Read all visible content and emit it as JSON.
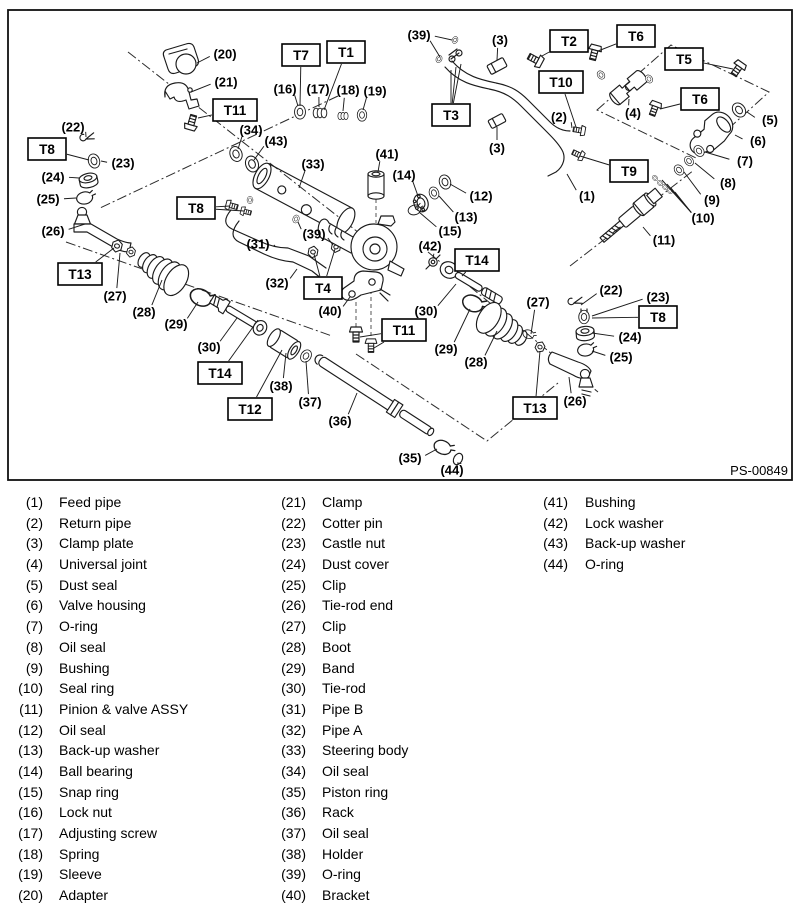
{
  "figure": {
    "code": "PS-00849",
    "part_labels": [
      {
        "t": "(20)",
        "x": 225,
        "y": 54,
        "leads": [
          [
            197,
            63
          ]
        ]
      },
      {
        "t": "(21)",
        "x": 226,
        "y": 82,
        "leads": [
          [
            191,
            92
          ]
        ]
      },
      {
        "t": "(16)",
        "x": 285,
        "y": 89,
        "leads": [
          [
            298,
            106
          ]
        ]
      },
      {
        "t": "(17)",
        "x": 318,
        "y": 89,
        "leads": [
          [
            319,
            107
          ]
        ]
      },
      {
        "t": "(18)",
        "x": 348,
        "y": 90,
        "leads": [
          [
            343,
            111
          ]
        ]
      },
      {
        "t": "(19)",
        "x": 375,
        "y": 91,
        "leads": [
          [
            363,
            110
          ]
        ]
      },
      {
        "t": "(22)",
        "x": 73,
        "y": 127,
        "leads": [
          [
            86,
            137
          ]
        ]
      },
      {
        "t": "(23)",
        "x": 123,
        "y": 163,
        "leads": [
          [
            101,
            161
          ]
        ]
      },
      {
        "t": "(24)",
        "x": 53,
        "y": 177,
        "leads": [
          [
            79,
            178
          ]
        ]
      },
      {
        "t": "(25)",
        "x": 48,
        "y": 199,
        "leads": [
          [
            76,
            198
          ]
        ]
      },
      {
        "t": "(26)",
        "x": 53,
        "y": 231,
        "leads": [
          [
            85,
            224
          ]
        ]
      },
      {
        "t": "(34)",
        "x": 251,
        "y": 130,
        "leads": [
          [
            238,
            149
          ]
        ]
      },
      {
        "t": "(43)",
        "x": 276,
        "y": 141,
        "leads": [
          [
            254,
            160
          ]
        ]
      },
      {
        "t": "(33)",
        "x": 313,
        "y": 164,
        "leads": [
          [
            299,
            188
          ]
        ]
      },
      {
        "t": "(41)",
        "x": 387,
        "y": 154,
        "leads": [
          [
            378,
            172
          ]
        ]
      },
      {
        "t": "(39)",
        "x": 314,
        "y": 234,
        "leads": [
          [
            298,
            222
          ],
          [
            333,
            245
          ]
        ]
      },
      {
        "t": "(39)",
        "x": 419,
        "y": 35,
        "leads": [
          [
            452,
            40
          ],
          [
            440,
            57
          ]
        ]
      },
      {
        "t": "(3)",
        "x": 500,
        "y": 40,
        "leads": [
          [
            497,
            60
          ]
        ]
      },
      {
        "t": "(3)",
        "x": 497,
        "y": 148,
        "leads": [
          [
            497,
            127
          ]
        ]
      },
      {
        "t": "(2)",
        "x": 559,
        "y": 117,
        "leads": [
          [
            572,
            128
          ]
        ]
      },
      {
        "t": "(1)",
        "x": 587,
        "y": 196,
        "leads": [
          [
            567,
            174
          ]
        ]
      },
      {
        "t": "(4)",
        "x": 633,
        "y": 113,
        "leads": [
          [
            629,
            99
          ]
        ]
      },
      {
        "t": "(5)",
        "x": 770,
        "y": 120,
        "leads": [
          [
            747,
            112
          ]
        ]
      },
      {
        "t": "(6)",
        "x": 758,
        "y": 141,
        "leads": [
          [
            735,
            135
          ]
        ]
      },
      {
        "t": "(7)",
        "x": 745,
        "y": 161,
        "leads": [
          [
            705,
            152
          ]
        ]
      },
      {
        "t": "(8)",
        "x": 728,
        "y": 183,
        "leads": [
          [
            695,
            163
          ]
        ]
      },
      {
        "t": "(9)",
        "x": 712,
        "y": 200,
        "leads": [
          [
            684,
            172
          ]
        ]
      },
      {
        "t": "(10)",
        "x": 703,
        "y": 218,
        "leads": [
          [
            667,
            184
          ],
          [
            671,
            188
          ],
          [
            675,
            192
          ],
          [
            662,
            180
          ]
        ]
      },
      {
        "t": "(11)",
        "x": 664,
        "y": 240,
        "leads": [
          [
            643,
            227
          ]
        ]
      },
      {
        "t": "(12)",
        "x": 481,
        "y": 196,
        "leads": [
          [
            450,
            184
          ]
        ]
      },
      {
        "t": "(13)",
        "x": 466,
        "y": 217,
        "leads": [
          [
            439,
            196
          ]
        ]
      },
      {
        "t": "(14)",
        "x": 404,
        "y": 175,
        "leads": [
          [
            418,
            196
          ]
        ]
      },
      {
        "t": "(15)",
        "x": 450,
        "y": 231,
        "leads": [
          [
            419,
            212
          ]
        ]
      },
      {
        "t": "(42)",
        "x": 430,
        "y": 246,
        "leads": [
          [
            433,
            258
          ]
        ]
      },
      {
        "t": "(30)",
        "x": 426,
        "y": 311,
        "leads": [
          [
            456,
            284
          ]
        ]
      },
      {
        "t": "(29)",
        "x": 446,
        "y": 349,
        "leads": [
          [
            470,
            309
          ]
        ]
      },
      {
        "t": "(28)",
        "x": 476,
        "y": 362,
        "leads": [
          [
            497,
            331
          ]
        ]
      },
      {
        "t": "(27)",
        "x": 538,
        "y": 302,
        "leads": [
          [
            531,
            334
          ]
        ]
      },
      {
        "t": "(22)",
        "x": 611,
        "y": 290,
        "leads": [
          [
            581,
            305
          ]
        ]
      },
      {
        "t": "(23)",
        "x": 658,
        "y": 297,
        "leads": [
          [
            592,
            316
          ]
        ]
      },
      {
        "t": "(24)",
        "x": 630,
        "y": 337,
        "leads": [
          [
            592,
            333
          ]
        ]
      },
      {
        "t": "(25)",
        "x": 621,
        "y": 357,
        "leads": [
          [
            592,
            351
          ]
        ]
      },
      {
        "t": "(26)",
        "x": 575,
        "y": 401,
        "leads": [
          [
            569,
            377
          ]
        ]
      },
      {
        "t": "(27)",
        "x": 115,
        "y": 296,
        "leads": [
          [
            120,
            253
          ]
        ]
      },
      {
        "t": "(28)",
        "x": 144,
        "y": 312,
        "leads": [
          [
            162,
            280
          ]
        ]
      },
      {
        "t": "(29)",
        "x": 176,
        "y": 324,
        "leads": [
          [
            198,
            302
          ]
        ]
      },
      {
        "t": "(30)",
        "x": 209,
        "y": 347,
        "leads": [
          [
            237,
            318
          ]
        ]
      },
      {
        "t": "(31)",
        "x": 258,
        "y": 244,
        "leads": [
          [
            275,
            246
          ]
        ]
      },
      {
        "t": "(32)",
        "x": 277,
        "y": 283,
        "leads": [
          [
            297,
            269
          ]
        ]
      },
      {
        "t": "(40)",
        "x": 330,
        "y": 311,
        "leads": [
          [
            350,
            297
          ]
        ]
      },
      {
        "t": "(38)",
        "x": 281,
        "y": 386,
        "leads": [
          [
            286,
            353
          ]
        ]
      },
      {
        "t": "(37)",
        "x": 310,
        "y": 402,
        "leads": [
          [
            306,
            361
          ]
        ]
      },
      {
        "t": "(36)",
        "x": 340,
        "y": 421,
        "leads": [
          [
            357,
            393
          ]
        ]
      },
      {
        "t": "(35)",
        "x": 410,
        "y": 458,
        "leads": [
          [
            437,
            449
          ]
        ]
      },
      {
        "t": "(44)",
        "x": 452,
        "y": 470,
        "leads": [
          [
            457,
            463
          ]
        ]
      }
    ],
    "torque_labels": [
      {
        "t": "T7",
        "x": 301,
        "y": 55,
        "leads": [
          [
            300,
            106
          ]
        ]
      },
      {
        "t": "T1",
        "x": 346,
        "y": 52,
        "leads": [
          [
            324,
            110
          ]
        ]
      },
      {
        "t": "T11",
        "x": 235,
        "y": 110,
        "leads": [
          [
            198,
            118
          ]
        ]
      },
      {
        "t": "T8",
        "x": 47,
        "y": 149,
        "leads": [
          [
            89,
            160
          ]
        ]
      },
      {
        "t": "T8",
        "x": 196,
        "y": 208,
        "leads": [
          [
            230,
            206
          ],
          [
            244,
            211
          ]
        ]
      },
      {
        "t": "T13",
        "x": 80,
        "y": 274,
        "leads": [
          [
            114,
            248
          ]
        ]
      },
      {
        "t": "T14",
        "x": 220,
        "y": 373,
        "leads": [
          [
            258,
            320
          ]
        ]
      },
      {
        "t": "T12",
        "x": 250,
        "y": 409,
        "leads": [
          [
            282,
            350
          ]
        ]
      },
      {
        "t": "T2",
        "x": 569,
        "y": 41,
        "leads": [
          [
            542,
            56
          ]
        ]
      },
      {
        "t": "T6",
        "x": 636,
        "y": 36,
        "leads": [
          [
            598,
            51
          ]
        ]
      },
      {
        "t": "T10",
        "x": 561,
        "y": 82,
        "leads": [
          [
            576,
            127
          ]
        ]
      },
      {
        "t": "T5",
        "x": 684,
        "y": 59,
        "leads": [
          [
            733,
            69
          ]
        ]
      },
      {
        "t": "T6",
        "x": 700,
        "y": 99,
        "leads": [
          [
            660,
            109
          ]
        ]
      },
      {
        "t": "T3",
        "x": 451,
        "y": 115,
        "leads": [
          [
            451,
            70
          ],
          [
            456,
            67
          ],
          [
            461,
            64
          ]
        ]
      },
      {
        "t": "T9",
        "x": 629,
        "y": 171,
        "leads": [
          [
            580,
            156
          ]
        ]
      },
      {
        "t": "T4",
        "x": 323,
        "y": 288,
        "leads": [
          [
            314,
            254
          ],
          [
            335,
            249
          ]
        ]
      },
      {
        "t": "T11",
        "x": 404,
        "y": 330,
        "leads": [
          [
            360,
            337
          ],
          [
            374,
            348
          ]
        ]
      },
      {
        "t": "T14",
        "x": 477,
        "y": 260,
        "leads": [
          [
            462,
            276
          ]
        ]
      },
      {
        "t": "T8",
        "x": 658,
        "y": 317,
        "leads": [
          [
            592,
            318
          ]
        ]
      },
      {
        "t": "T13",
        "x": 535,
        "y": 408,
        "leads": [
          [
            540,
            351
          ]
        ]
      }
    ]
  },
  "legend": {
    "columns": [
      {
        "items": [
          {
            "num": "(1)",
            "name": "Feed pipe"
          },
          {
            "num": "(2)",
            "name": "Return pipe"
          },
          {
            "num": "(3)",
            "name": "Clamp plate"
          },
          {
            "num": "(4)",
            "name": "Universal joint"
          },
          {
            "num": "(5)",
            "name": "Dust seal"
          },
          {
            "num": "(6)",
            "name": "Valve housing"
          },
          {
            "num": "(7)",
            "name": "O-ring"
          },
          {
            "num": "(8)",
            "name": "Oil seal"
          },
          {
            "num": "(9)",
            "name": "Bushing"
          },
          {
            "num": "(10)",
            "name": "Seal ring"
          },
          {
            "num": "(11)",
            "name": "Pinion & valve ASSY"
          },
          {
            "num": "(12)",
            "name": "Oil seal"
          },
          {
            "num": "(13)",
            "name": "Back-up washer"
          },
          {
            "num": "(14)",
            "name": "Ball bearing"
          },
          {
            "num": "(15)",
            "name": "Snap ring"
          },
          {
            "num": "(16)",
            "name": "Lock nut"
          },
          {
            "num": "(17)",
            "name": "Adjusting screw"
          },
          {
            "num": "(18)",
            "name": "Spring"
          },
          {
            "num": "(19)",
            "name": "Sleeve"
          },
          {
            "num": "(20)",
            "name": "Adapter"
          }
        ]
      },
      {
        "items": [
          {
            "num": "(21)",
            "name": "Clamp"
          },
          {
            "num": "(22)",
            "name": "Cotter pin"
          },
          {
            "num": "(23)",
            "name": "Castle nut"
          },
          {
            "num": "(24)",
            "name": "Dust cover"
          },
          {
            "num": "(25)",
            "name": "Clip"
          },
          {
            "num": "(26)",
            "name": "Tie-rod end"
          },
          {
            "num": "(27)",
            "name": "Clip"
          },
          {
            "num": "(28)",
            "name": "Boot"
          },
          {
            "num": "(29)",
            "name": "Band"
          },
          {
            "num": "(30)",
            "name": "Tie-rod"
          },
          {
            "num": "(31)",
            "name": "Pipe B"
          },
          {
            "num": "(32)",
            "name": "Pipe A"
          },
          {
            "num": "(33)",
            "name": "Steering body"
          },
          {
            "num": "(34)",
            "name": "Oil seal"
          },
          {
            "num": "(35)",
            "name": "Piston ring"
          },
          {
            "num": "(36)",
            "name": "Rack"
          },
          {
            "num": "(37)",
            "name": "Oil seal"
          },
          {
            "num": "(38)",
            "name": "Holder"
          },
          {
            "num": "(39)",
            "name": "O-ring"
          },
          {
            "num": "(40)",
            "name": "Bracket"
          }
        ]
      },
      {
        "items": [
          {
            "num": "(41)",
            "name": "Bushing"
          },
          {
            "num": "(42)",
            "name": "Lock washer"
          },
          {
            "num": "(43)",
            "name": "Back-up washer"
          },
          {
            "num": "(44)",
            "name": "O-ring"
          }
        ]
      }
    ]
  }
}
